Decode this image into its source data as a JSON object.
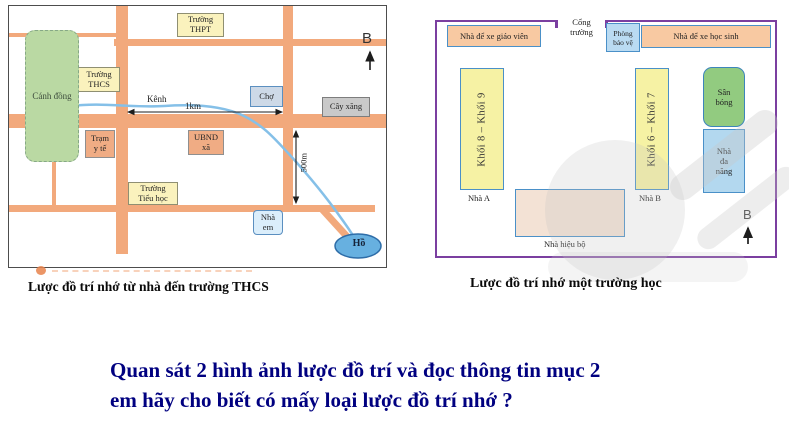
{
  "left_map": {
    "caption": "Lược đồ trí nhớ từ nhà đến trường THCS",
    "compass": "B",
    "canal_label": "Kênh",
    "distance_horizontal": "1km",
    "distance_vertical": "500m",
    "places": {
      "thpt": "Trường\nTHPT",
      "thcs": "Trường\nTHCS",
      "canh_dong": "Cánh đồng",
      "cho": "Chợ",
      "cay_xang": "Cây xăng",
      "tram_y_te": "Trạm\ny tế",
      "ubnd_xa": "UBND\nxã",
      "truong_tieu_hoc": "Trường\nTiểu học",
      "nha_em": "Nhà\nem",
      "ho": "Hồ"
    }
  },
  "right_map": {
    "caption": "Lược đồ trí nhớ một trường học",
    "compass": "B",
    "gate_label": "Cổng\ntrường",
    "places": {
      "nha_xe_giao_vien": "Nhà để xe giáo viên",
      "phong_bao_ve": "Phòng\nbảo vệ",
      "nha_xe_hoc_sinh": "Nhà để xe học sinh",
      "khoi_8_9": "Khối 8 – Khối 9",
      "khoi_6_7": "Khối 6 – Khối 7",
      "san_bong": "Sân\nbóng",
      "nha_da_nang": "Nhà\nđa\nnăng",
      "nha_a": "Nhà A",
      "nha_b": "Nhà B",
      "nha_hieu_bo": "Nhà hiệu bộ"
    }
  },
  "question": {
    "line1": "Quan sát 2 hình ảnh lược đồ trí và đọc thông tin mục 2",
    "line2": "em hãy cho biết có mấy loại lược đồ trí nhớ ?"
  },
  "colors": {
    "road": "#f2a97c",
    "canal": "#85c0e8",
    "fence": "#7b3fa0",
    "question_text": "#000080"
  }
}
